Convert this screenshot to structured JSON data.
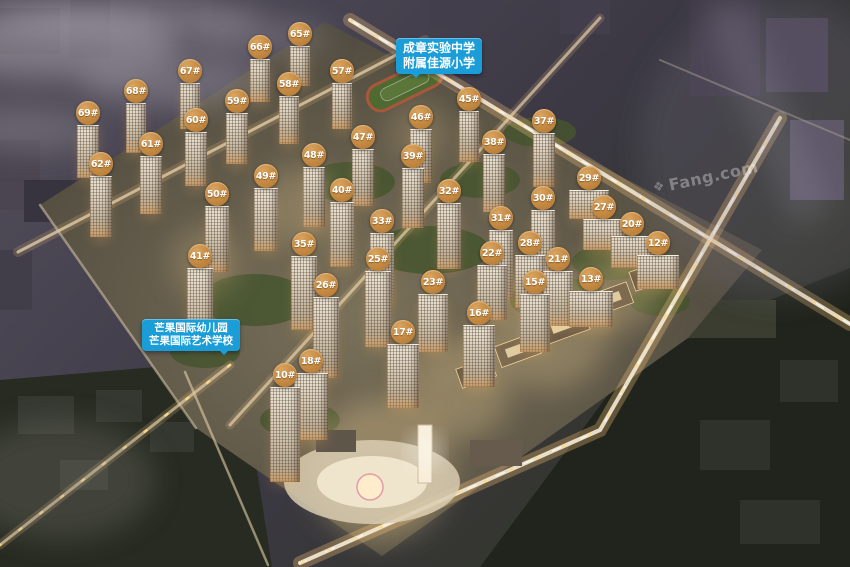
{
  "image": {
    "description": "aerial night rendering of residential development masterplan",
    "watermark": "Fang.com"
  },
  "callouts": {
    "school_north": {
      "lines": [
        "成章实验中学",
        "附属佳源小学"
      ]
    },
    "school_west": {
      "lines": [
        "芒果国际幼儿园",
        "芒果国际艺术学校"
      ]
    }
  },
  "colors": {
    "marker": "#c68b44",
    "callout": "#1b9ed8",
    "text": "#ffffff",
    "watermark": "rgba(255,255,255,0.33)"
  },
  "markers": [
    {
      "label": "65#",
      "x": 300,
      "y": 34,
      "s": "hi"
    },
    {
      "label": "66#",
      "x": 260,
      "y": 47,
      "s": "hi"
    },
    {
      "label": "67#",
      "x": 190,
      "y": 71,
      "s": "hi"
    },
    {
      "label": "57#",
      "x": 342,
      "y": 71,
      "s": "hi"
    },
    {
      "label": "58#",
      "x": 289,
      "y": 84,
      "s": "hi"
    },
    {
      "label": "68#",
      "x": 136,
      "y": 91,
      "s": "hi"
    },
    {
      "label": "45#",
      "x": 469,
      "y": 99,
      "s": "hi"
    },
    {
      "label": "59#",
      "x": 237,
      "y": 101,
      "s": "hi"
    },
    {
      "label": "69#",
      "x": 88,
      "y": 113,
      "s": "hi"
    },
    {
      "label": "46#",
      "x": 421,
      "y": 117,
      "s": "hi"
    },
    {
      "label": "60#",
      "x": 196,
      "y": 120,
      "s": "hi"
    },
    {
      "label": "37#",
      "x": 544,
      "y": 121,
      "s": "hi"
    },
    {
      "label": "47#",
      "x": 363,
      "y": 137,
      "s": "hi"
    },
    {
      "label": "38#",
      "x": 494,
      "y": 142,
      "s": "hi"
    },
    {
      "label": "61#",
      "x": 151,
      "y": 144,
      "s": "hi"
    },
    {
      "label": "48#",
      "x": 314,
      "y": 155,
      "s": "hi"
    },
    {
      "label": "39#",
      "x": 413,
      "y": 156,
      "s": "hi"
    },
    {
      "label": "62#",
      "x": 101,
      "y": 164,
      "s": "hi"
    },
    {
      "label": "49#",
      "x": 266,
      "y": 176,
      "s": "hi"
    },
    {
      "label": "29#",
      "x": 589,
      "y": 178,
      "s": "low"
    },
    {
      "label": "40#",
      "x": 342,
      "y": 190,
      "s": "hi"
    },
    {
      "label": "32#",
      "x": 449,
      "y": 191,
      "s": "hi"
    },
    {
      "label": "50#",
      "x": 217,
      "y": 194,
      "s": "hi"
    },
    {
      "label": "30#",
      "x": 543,
      "y": 198,
      "s": "hi"
    },
    {
      "label": "27#",
      "x": 604,
      "y": 207,
      "s": "low"
    },
    {
      "label": "31#",
      "x": 501,
      "y": 218,
      "s": "hi"
    },
    {
      "label": "33#",
      "x": 382,
      "y": 221,
      "s": "hi"
    },
    {
      "label": "20#",
      "x": 632,
      "y": 224,
      "s": "low"
    },
    {
      "label": "28#",
      "x": 530,
      "y": 243,
      "s": "mid"
    },
    {
      "label": "12#",
      "x": 658,
      "y": 243,
      "s": "low"
    },
    {
      "label": "35#",
      "x": 304,
      "y": 244,
      "s": "hi"
    },
    {
      "label": "22#",
      "x": 492,
      "y": 253,
      "s": "mid"
    },
    {
      "label": "41#",
      "x": 200,
      "y": 256,
      "s": "hi"
    },
    {
      "label": "21#",
      "x": 558,
      "y": 259,
      "s": "mid"
    },
    {
      "label": "25#",
      "x": 378,
      "y": 259,
      "s": "hi"
    },
    {
      "label": "13#",
      "x": 591,
      "y": 279,
      "s": "low"
    },
    {
      "label": "23#",
      "x": 433,
      "y": 282,
      "s": "mid"
    },
    {
      "label": "15#",
      "x": 535,
      "y": 282,
      "s": "mid"
    },
    {
      "label": "26#",
      "x": 326,
      "y": 285,
      "s": "hi"
    },
    {
      "label": "16#",
      "x": 479,
      "y": 313,
      "s": "mid"
    },
    {
      "label": "17#",
      "x": 403,
      "y": 332,
      "s": "mid"
    },
    {
      "label": "18#",
      "x": 311,
      "y": 361,
      "s": "mid"
    },
    {
      "label": "10#",
      "x": 285,
      "y": 375,
      "s": "hi"
    }
  ]
}
